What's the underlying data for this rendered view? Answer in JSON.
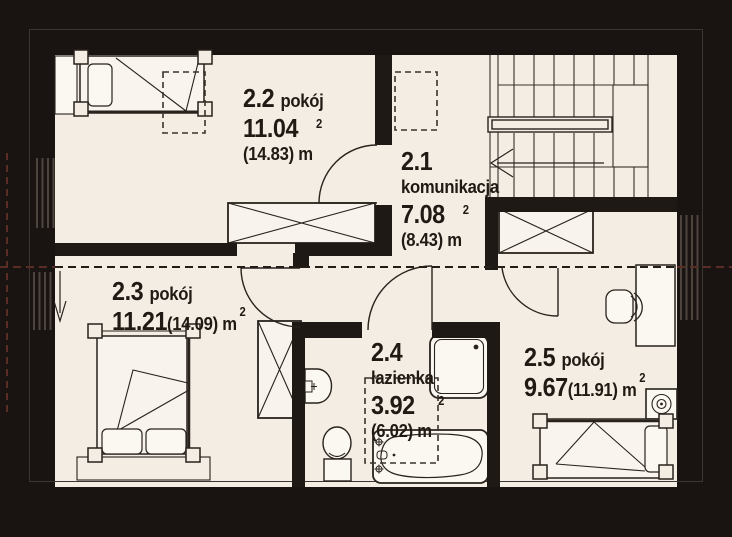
{
  "plan_title": "floor-plan-upper-storey",
  "rooms": [
    {
      "id": "2.2",
      "type": "pokój",
      "area": "11.04",
      "total": "(14.83) m",
      "sup": "2"
    },
    {
      "id": "2.1",
      "type": "komunikacja",
      "area": "7.08",
      "total": "(8.43) m",
      "sup": "2"
    },
    {
      "id": "2.3",
      "type": "pokój",
      "area": "11.21",
      "total": "(14.09) m",
      "sup": "2"
    },
    {
      "id": "2.4",
      "type": "łazienka",
      "area": "3.92",
      "total": "(6.02) m",
      "sup": "2"
    },
    {
      "id": "2.5",
      "type": "pokój",
      "area": "9.67",
      "total": "(11.91) m",
      "sup": "2"
    }
  ],
  "colors": {
    "background": "#191412",
    "wall": "#1f1915",
    "floor": "#f3ede4",
    "line": "#29221d",
    "roof_slope_dash_on_floor": "#241c16",
    "roof_slope_dash_on_wall": "#5a2d24",
    "furniture_fill": "#f9f4ed"
  }
}
